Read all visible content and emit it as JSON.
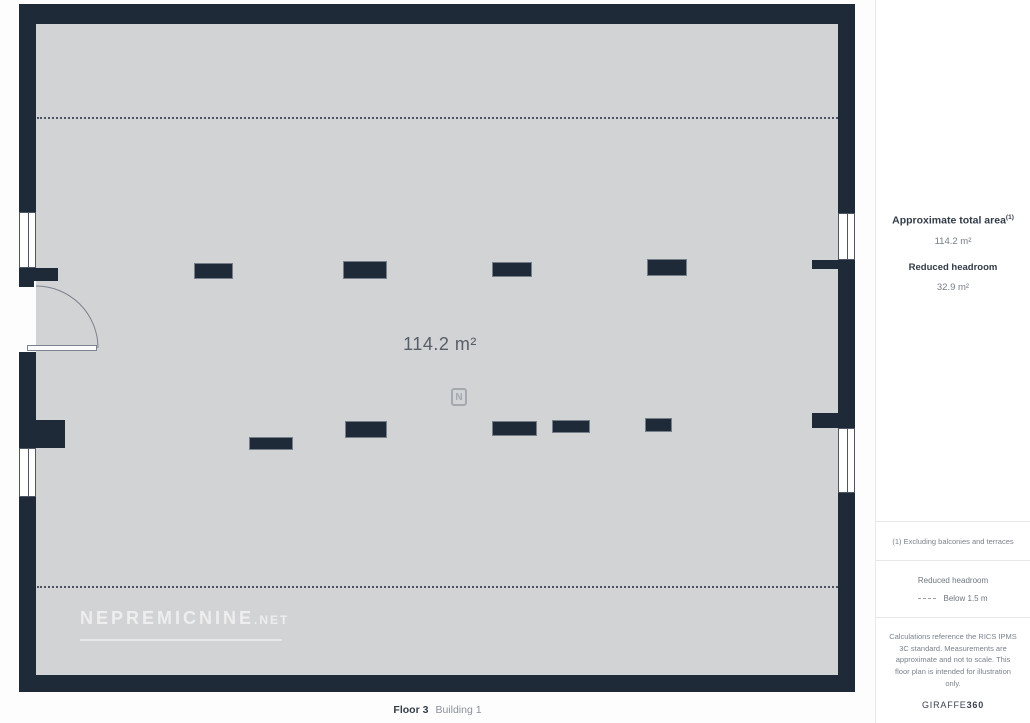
{
  "colors": {
    "wall": "#1f2a38",
    "floor": "#d2d3d5",
    "text-dark": "#323b48",
    "text-gray": "#767d87"
  },
  "plan": {
    "area_label": "114.2 m²",
    "compass_letter": "N",
    "watermark_text": "NEPREMICNINE",
    "watermark_suffix": ".NET",
    "floor_label": "Floor 3",
    "building_label": "Building 1"
  },
  "sidebar": {
    "total_area_label": "Approximate total area",
    "total_area_footnote_marker": "(1)",
    "total_area_value": "114.2 m²",
    "reduced_headroom_label": "Reduced headroom",
    "reduced_headroom_value": "32.9 m²",
    "footnote": "(1) Excluding balconies and terraces",
    "legend_title": "Reduced headroom",
    "legend_value": "Below 1.5 m",
    "disclaimer": "Calculations reference the RICS IPMS 3C standard. Measurements are approximate and not to scale. This floor plan is intended for illustration only.",
    "brand_name": "GIRAFFE",
    "brand_number": "360"
  }
}
